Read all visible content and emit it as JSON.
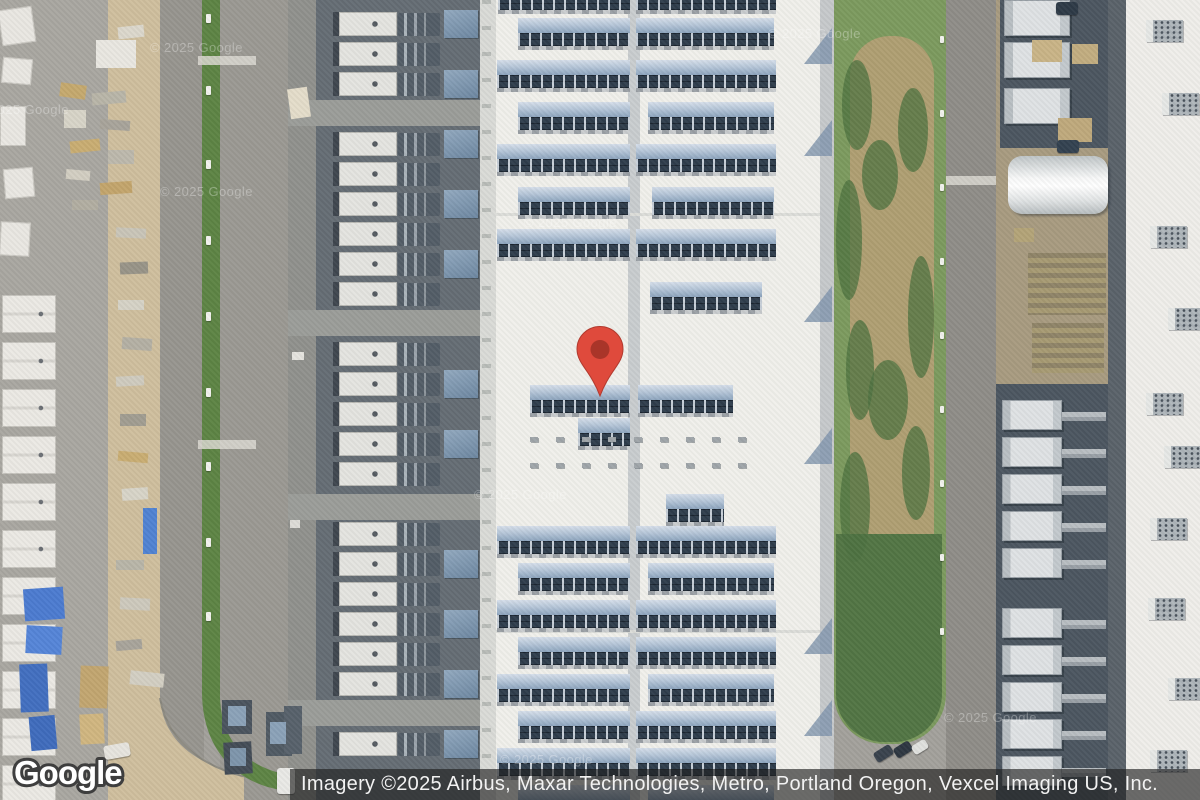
{
  "logo": {
    "text": "Google"
  },
  "attribution": {
    "text": "Imagery ©2025 Airbus, Maxar Technologies, Metro, Portland Oregon, Vexcel Imaging US, Inc."
  },
  "watermarks": [
    {
      "text": "© 2025 Google",
      "x": 150,
      "y": 40
    },
    {
      "text": "© 2025 Google",
      "x": -24,
      "y": 102
    },
    {
      "text": "© 2025 Google",
      "x": 160,
      "y": 184
    },
    {
      "text": "© 2025 Google",
      "x": 524,
      "y": 215
    },
    {
      "text": "© 2025 Google",
      "x": 768,
      "y": 26
    },
    {
      "text": "© 2025 Google",
      "x": 474,
      "y": 487
    },
    {
      "text": "© 2025 Google",
      "x": 944,
      "y": 710
    },
    {
      "text": "© 2025 Google",
      "x": 500,
      "y": 752
    }
  ],
  "marker": {
    "fill": "#DF4A3C",
    "stroke": "#B23A2E",
    "inner": "#A93529",
    "tip_x": 600,
    "tip_y": 398
  },
  "colors": {
    "pin_red": "#DF4A3C",
    "pin_inner": "#A93529",
    "attribution_bg": "rgba(32,32,32,0.64)",
    "roof_white": "#f1f0eb",
    "panel_navy": "#2f3d4c",
    "vegetation_green": "#5d8444",
    "pavement": "#a3a19c"
  },
  "scene": {
    "zones": [
      [
        "base",
        0,
        0,
        1200,
        800,
        "#a3a19c"
      ],
      [
        "left-yard",
        0,
        0,
        108,
        800,
        "#a9a7a1"
      ],
      [
        "tan-strip",
        108,
        0,
        52,
        700,
        "#cfbf9e"
      ],
      [
        "road-west",
        160,
        0,
        44,
        800,
        "#97958f"
      ],
      [
        "green-strip-west",
        202,
        0,
        18,
        642,
        "#5d8444"
      ],
      [
        "road-mid",
        220,
        0,
        68,
        800,
        "#9b9993"
      ],
      [
        "west-lane",
        288,
        0,
        28,
        800,
        "#90918d"
      ],
      [
        "west-pad",
        316,
        0,
        164,
        800,
        "#656d74"
      ],
      [
        "building-edge-west",
        480,
        0,
        16,
        800,
        "#dadbd7"
      ],
      [
        "building-walkway",
        482,
        0,
        9,
        800,
        "transparent",
        "background-image:repeating-linear-gradient(180deg,#b9bcb8 0 4px,rgba(0,0,0,0) 4px 26px);"
      ],
      [
        "main-roof",
        496,
        0,
        324,
        800,
        "#f1f0eb"
      ],
      [
        "roof-spine",
        628,
        0,
        12,
        800,
        "#c9cdcf"
      ],
      [
        "building-edge-east",
        820,
        0,
        14,
        800,
        "#c6c9cb"
      ],
      [
        "green-strip-east",
        834,
        0,
        112,
        744,
        "#7c9a5e",
        "border-radius:0 0 50px 50px;"
      ],
      [
        "green-dry-band",
        850,
        36,
        84,
        560,
        "#af9f72",
        "border-radius:40px;"
      ],
      [
        "green-dense-south",
        836,
        534,
        106,
        208,
        "#527544",
        "border-radius:0 0 48px 48px;"
      ],
      [
        "road-east",
        946,
        0,
        50,
        800,
        "#8f8d88"
      ],
      [
        "east-dirt",
        996,
        0,
        112,
        800,
        "#a89b80"
      ],
      [
        "east-pad-north",
        1000,
        0,
        108,
        148,
        "#4c5660"
      ],
      [
        "east-pad-south",
        996,
        384,
        112,
        416,
        "#4c5660"
      ],
      [
        "east-dark-strip",
        1108,
        0,
        18,
        800,
        "#5a626a"
      ],
      [
        "east-roof",
        1126,
        0,
        74,
        800,
        "#efeeea"
      ]
    ],
    "paths": [
      {
        "n": "dirt-road-curve",
        "d": "M108,698 L160,698 C163,740 196,766 244,774 L244,800 L108,800 Z",
        "f": "#cfbf9e"
      },
      {
        "n": "curb-curve",
        "d": "M160,698 C168,746 210,772 262,780",
        "f": "none",
        "st": "#8b897f",
        "sw": 2
      },
      {
        "n": "green-curve",
        "d": "M202,640 L220,640 L220,700 C223,744 248,766 284,774 L281,790 C234,782 203,748 202,694 Z",
        "f": "#5d8444"
      }
    ],
    "cross_lanes": [
      [
        288,
        100,
        192,
        26
      ],
      [
        288,
        310,
        192,
        26
      ],
      [
        288,
        494,
        192,
        26
      ],
      [
        288,
        700,
        192,
        26
      ]
    ],
    "joints": [
      [
        496,
        213,
        324,
        3
      ],
      [
        496,
        630,
        324,
        3
      ]
    ],
    "panel_rows": [
      {
        "y": -18,
        "s": [
          [
            498,
            132
          ],
          [
            636,
            140
          ]
        ]
      },
      {
        "y": 18,
        "s": [
          [
            518,
            112
          ],
          [
            636,
            138
          ]
        ]
      },
      {
        "y": 60,
        "s": [
          [
            497,
            133
          ],
          [
            636,
            140
          ]
        ]
      },
      {
        "y": 102,
        "s": [
          [
            518,
            112
          ],
          [
            648,
            126
          ]
        ]
      },
      {
        "y": 144,
        "s": [
          [
            497,
            133
          ],
          [
            636,
            140
          ]
        ]
      },
      {
        "y": 187,
        "s": [
          [
            518,
            112
          ],
          [
            652,
            122
          ]
        ]
      },
      {
        "y": 229,
        "s": [
          [
            497,
            133
          ],
          [
            636,
            140
          ]
        ]
      },
      {
        "y": 282,
        "s": [
          [
            650,
            112
          ]
        ]
      },
      {
        "y": 385,
        "s": [
          [
            530,
            100
          ],
          [
            638,
            95
          ]
        ]
      },
      {
        "y": 418,
        "s": [
          [
            578,
            52
          ]
        ]
      },
      {
        "y": 494,
        "s": [
          [
            666,
            58
          ]
        ]
      },
      {
        "y": 526,
        "s": [
          [
            497,
            133
          ],
          [
            636,
            140
          ]
        ]
      },
      {
        "y": 563,
        "s": [
          [
            518,
            112
          ],
          [
            648,
            126
          ]
        ]
      },
      {
        "y": 600,
        "s": [
          [
            497,
            133
          ],
          [
            636,
            140
          ]
        ]
      },
      {
        "y": 637,
        "s": [
          [
            518,
            112
          ],
          [
            636,
            140
          ]
        ]
      },
      {
        "y": 674,
        "s": [
          [
            497,
            133
          ],
          [
            648,
            126
          ]
        ]
      },
      {
        "y": 711,
        "s": [
          [
            518,
            112
          ],
          [
            636,
            140
          ]
        ]
      },
      {
        "y": 748,
        "s": [
          [
            497,
            133
          ],
          [
            636,
            140
          ]
        ]
      },
      {
        "y": 785,
        "s": [
          [
            518,
            112
          ],
          [
            648,
            126
          ]
        ]
      }
    ],
    "vents": {
      "ys": [
        437,
        463
      ],
      "x0": 530,
      "step": 26,
      "count": 9,
      "w": 8,
      "h": 5
    },
    "west_yard": {
      "unit": {
        "x": 333,
        "w": 58,
        "h": 24
      },
      "pipe": {
        "x": 398,
        "w": 42,
        "h": 23
      },
      "block": {
        "x": 444,
        "w": 34,
        "h": 28
      },
      "y0": 12,
      "step": 30,
      "count": 25,
      "skip": [
        3,
        10,
        16,
        23
      ]
    },
    "east_yard": {
      "big_ys": [
        0,
        42,
        88
      ],
      "big": {
        "x": 1004,
        "w": 66,
        "h": 36
      },
      "unit_ys": [
        400,
        437,
        474,
        511,
        548,
        608,
        645,
        682,
        719,
        756
      ],
      "unit": {
        "x": 1002,
        "w": 60,
        "h": 30
      },
      "pipe": {
        "x": 1062,
        "w": 44
      }
    },
    "tent": [
      1008,
      156,
      100,
      58
    ],
    "pallets": [
      [
        1028,
        253,
        78,
        62
      ],
      [
        1032,
        323,
        72,
        50
      ]
    ],
    "roof_units": [
      [
        1146,
        20
      ],
      [
        1162,
        93
      ],
      [
        1150,
        226
      ],
      [
        1168,
        308
      ],
      [
        1146,
        393
      ],
      [
        1164,
        446
      ],
      [
        1150,
        518
      ],
      [
        1148,
        598
      ],
      [
        1168,
        678
      ],
      [
        1150,
        750
      ]
    ],
    "trailers": {
      "x": 2,
      "y0": 295,
      "step": 47,
      "count": 11,
      "w": 54,
      "h": 38
    },
    "trailer_sm": [
      [
        0,
        8,
        34,
        36,
        -8
      ],
      [
        2,
        58,
        30,
        26,
        5
      ],
      [
        0,
        106,
        26,
        40,
        0
      ],
      [
        4,
        168,
        30,
        30,
        -5
      ],
      [
        0,
        222,
        30,
        34,
        3
      ]
    ],
    "materials": [
      [
        96,
        40,
        40,
        28,
        "#e9e7e1",
        0
      ],
      [
        118,
        26,
        26,
        12,
        "#dcd8cc",
        -6
      ],
      [
        60,
        84,
        26,
        14,
        "#c5a96e",
        8
      ],
      [
        92,
        92,
        34,
        12,
        "#b9b5a8",
        -5
      ],
      [
        64,
        110,
        22,
        18,
        "#d8d4c8",
        0
      ],
      [
        100,
        120,
        30,
        10,
        "#a8a49a",
        4
      ],
      [
        70,
        140,
        30,
        12,
        "#c9ad72",
        -6
      ],
      [
        108,
        150,
        26,
        14,
        "#bdb9ac",
        0
      ],
      [
        66,
        170,
        24,
        10,
        "#d2cec2",
        5
      ],
      [
        100,
        182,
        32,
        12,
        "#c3a56c",
        -4
      ],
      [
        72,
        200,
        26,
        10,
        "#b2aea2",
        0
      ],
      [
        116,
        228,
        30,
        10,
        "#c9c5b8",
        3
      ],
      [
        120,
        262,
        28,
        12,
        "#989488",
        -2
      ],
      [
        118,
        300,
        26,
        10,
        "#d6d2c6",
        0
      ],
      [
        122,
        338,
        30,
        12,
        "#b4b0a4",
        4
      ],
      [
        116,
        376,
        28,
        10,
        "#cfcbbf",
        -3
      ],
      [
        120,
        414,
        26,
        12,
        "#a19d91",
        0
      ],
      [
        118,
        452,
        30,
        10,
        "#c9ad72",
        5
      ],
      [
        122,
        488,
        26,
        12,
        "#d8d4c8",
        -4
      ],
      [
        143,
        508,
        14,
        46,
        "#5083d2",
        0
      ],
      [
        116,
        560,
        28,
        10,
        "#b9b5a8",
        0
      ],
      [
        120,
        598,
        30,
        12,
        "#cdc9bd",
        3
      ],
      [
        116,
        640,
        26,
        10,
        "#a8a49a",
        -5
      ],
      [
        130,
        672,
        34,
        14,
        "#d3cfc3",
        6
      ],
      [
        24,
        588,
        40,
        32,
        "#4c7bd0",
        -4
      ],
      [
        26,
        626,
        36,
        28,
        "#5585d8",
        3
      ],
      [
        20,
        664,
        28,
        48,
        "#426fc0",
        -2
      ],
      [
        30,
        716,
        26,
        34,
        "#3f6cbd",
        -5
      ],
      [
        80,
        666,
        28,
        42,
        "#c2a670",
        2
      ],
      [
        80,
        714,
        24,
        30,
        "#d0b680",
        -3
      ],
      [
        289,
        88,
        20,
        30,
        "#e4ddca",
        -8
      ],
      [
        292,
        352,
        12,
        8,
        "#e5e4df",
        0
      ],
      [
        290,
        520,
        10,
        8,
        "#dddcd7",
        0
      ],
      [
        1032,
        40,
        30,
        22,
        "#c9b487",
        0
      ],
      [
        1072,
        44,
        26,
        20,
        "#c2ad80",
        0
      ],
      [
        1058,
        118,
        34,
        24,
        "#bfa97c",
        0
      ],
      [
        1014,
        228,
        20,
        14,
        "#b3a478",
        0
      ],
      [
        222,
        700,
        30,
        34,
        "#4b545e",
        0
      ],
      [
        224,
        742,
        28,
        32,
        "#434c56",
        -3
      ],
      [
        266,
        712,
        26,
        44,
        "#505a64",
        0
      ],
      [
        284,
        706,
        18,
        48,
        "#57616b",
        0
      ],
      [
        228,
        706,
        18,
        20,
        "#8ba2b8",
        0
      ],
      [
        230,
        748,
        16,
        18,
        "#7e95ab",
        0
      ],
      [
        270,
        722,
        16,
        22,
        "#8ba2b8",
        0
      ]
    ],
    "vehicles": [
      [
        277,
        768,
        18,
        26,
        "#e9e9e6",
        0
      ],
      [
        874,
        748,
        19,
        11,
        "#39424d",
        -32
      ],
      [
        894,
        744,
        18,
        11,
        "#2e3741",
        -32
      ],
      [
        912,
        742,
        16,
        10,
        "#e0e1de",
        -32
      ],
      [
        1056,
        2,
        22,
        13,
        "#2e3a47",
        0
      ],
      [
        1057,
        140,
        22,
        13,
        "#334150",
        0
      ],
      [
        104,
        744,
        26,
        14,
        "#e6e4de",
        -10
      ]
    ],
    "veg": [
      [
        842,
        60,
        30,
        90
      ],
      [
        836,
        180,
        26,
        120
      ],
      [
        846,
        320,
        28,
        100
      ],
      [
        840,
        452,
        30,
        110
      ],
      [
        898,
        88,
        30,
        84
      ],
      [
        908,
        256,
        26,
        122
      ],
      [
        902,
        426,
        28,
        94
      ],
      [
        862,
        140,
        36,
        70
      ],
      [
        868,
        360,
        40,
        80
      ]
    ],
    "shadows": [
      [
        804,
        28
      ],
      [
        804,
        120
      ],
      [
        804,
        286
      ],
      [
        804,
        428
      ],
      [
        804,
        618
      ],
      [
        804,
        700
      ]
    ],
    "posts": {
      "x": 206,
      "w": 5,
      "h": 9,
      "ys": [
        14,
        86,
        160,
        236,
        312,
        388,
        462,
        538,
        612
      ]
    },
    "posts_east": {
      "x": 940,
      "w": 4,
      "h": 7,
      "ys": [
        36,
        110,
        184,
        258,
        332,
        406,
        480,
        554,
        628
      ]
    },
    "crosswalks": [
      [
        198,
        56,
        58,
        9
      ],
      [
        198,
        440,
        58,
        9
      ],
      [
        946,
        176,
        50,
        9
      ]
    ]
  }
}
